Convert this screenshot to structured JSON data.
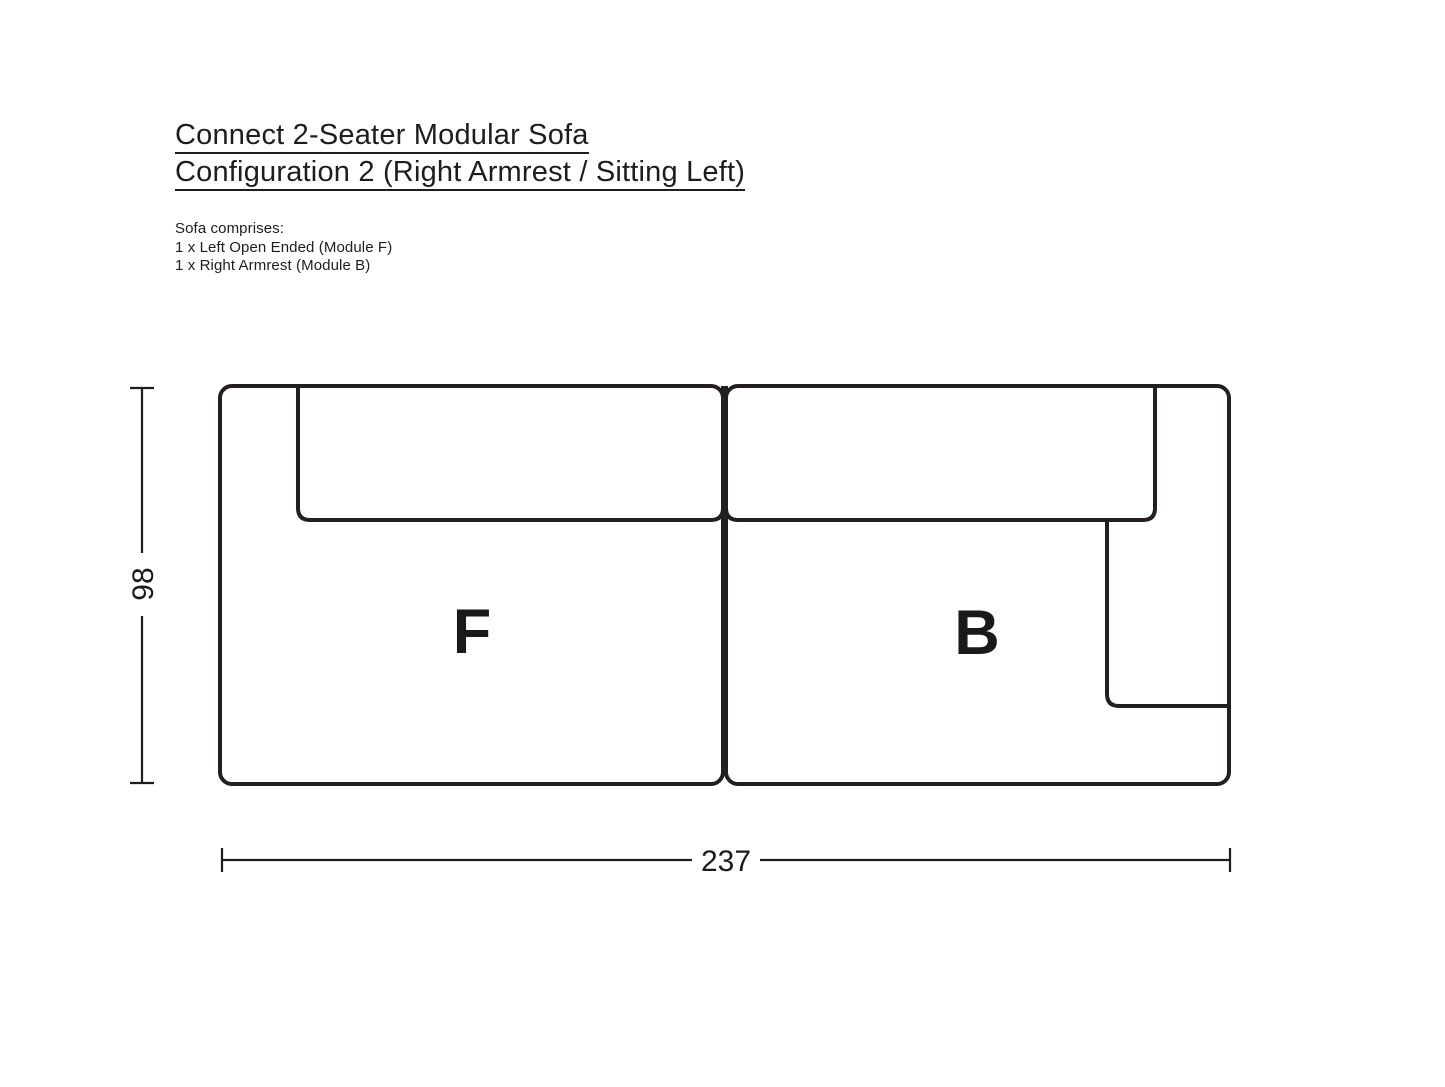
{
  "header": {
    "title_line1": "Connect 2-Seater Modular Sofa",
    "title_line2": "Configuration 2 (Right Armrest / Sitting Left)"
  },
  "composition": {
    "intro": "Sofa comprises:",
    "items": [
      "1 x Left Open Ended (Module F)",
      "1 x Right Armrest (Module B)"
    ]
  },
  "diagram": {
    "type": "top-view technical drawing of 2-module sofa",
    "modules": [
      {
        "label": "F"
      },
      {
        "label": "B"
      }
    ],
    "dimensions": {
      "height": "98",
      "width": "237"
    },
    "colors": {
      "line": "#231f20",
      "text": "#1a1a1a",
      "background": "#ffffff"
    }
  }
}
